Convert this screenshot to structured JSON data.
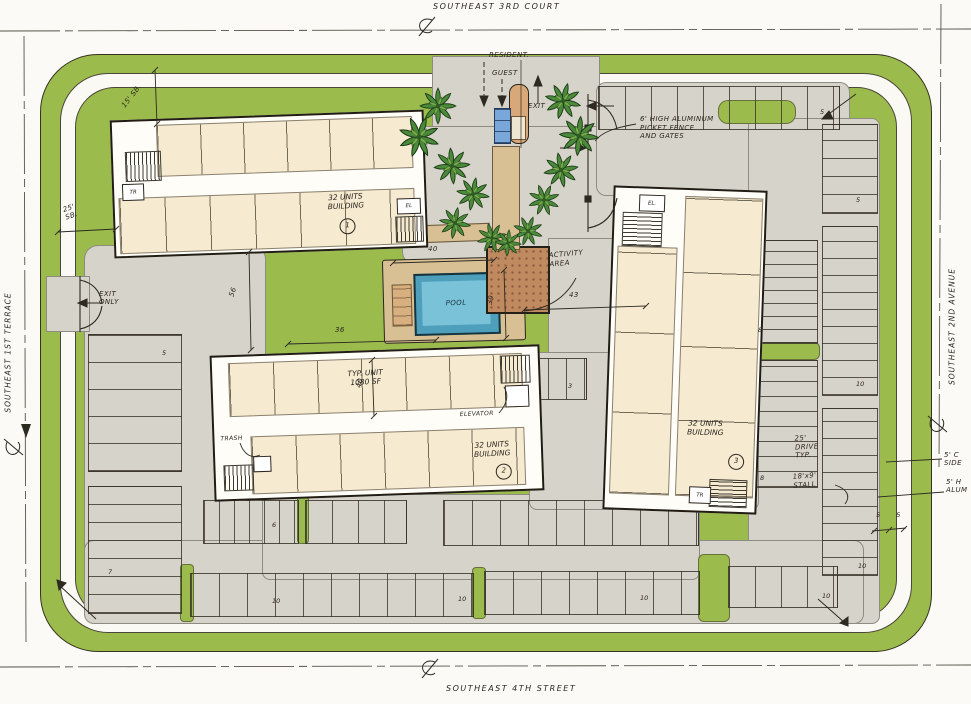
{
  "streets": {
    "top": "SOUTHEAST 3RD COURT",
    "bottom": "SOUTHEAST 4TH STREET",
    "left": "SOUTHEAST 1ST TERRACE",
    "right": "SOUTHEAST 2ND AVENUE"
  },
  "entrance": {
    "resident": "RESIDENT.",
    "guest": "GUEST",
    "exit": "EXIT"
  },
  "annotations": {
    "fence_l1": "6' HIGH ALUMINUM",
    "fence_l2": "PICKET FENCE",
    "fence_l3": "AND GATES",
    "exit_only_l1": "EXIT",
    "exit_only_l2": "ONLY",
    "drive_l1": "25'",
    "drive_l2": "DRIVE",
    "drive_l3": "TYP.",
    "stall_l1": "18'x9'",
    "stall_l2": "STALL",
    "edge1_l1": "5' C",
    "edge1_l2": "SIDE",
    "edge2_l1": "5' H",
    "edge2_l2": "ALUM"
  },
  "dimensions": {
    "front_setback_l1": "25'",
    "front_setback_l2": "SB.",
    "side_setback": "15' SB.",
    "d56": "56",
    "d36": "36",
    "d40_pool": "40",
    "d43": "43",
    "d39": "39",
    "d40_bldg2": "40",
    "d5_pair": "5 5"
  },
  "buildings": {
    "b1": {
      "label_l1": "32 UNITS",
      "label_l2": "BUILDING",
      "number": "1",
      "tr": "TR",
      "el": "EL"
    },
    "b2": {
      "label_l1": "32 UNITS",
      "label_l2": "BUILDING",
      "number": "2",
      "typ_l1": "TYP. UNIT",
      "typ_l2": "1080 SF",
      "elevator": "ELEVATOR",
      "trash": "TRASH"
    },
    "b3": {
      "label_l1": "32 UNITS",
      "label_l2": "BUILDING",
      "number": "3",
      "el": "EL.",
      "tr": "TR"
    }
  },
  "amenities": {
    "pool": "POOL",
    "activity_l1": "ACTIVITY",
    "activity_l2": "AREA"
  },
  "parking_counts": {
    "top_right": "5",
    "right_upper": "5",
    "right_mid": "10",
    "right_lower": "10",
    "east_upper": "8",
    "east_lower": "8",
    "bottom_1": "10",
    "bottom_2": "10",
    "bottom_3": "10",
    "bottom_4": "10",
    "left_upper": "5",
    "left_lower": "7",
    "mid_island": "6",
    "guest_small": "3"
  },
  "colors": {
    "landscape": "#9BBB4C",
    "pavement": "#D6D3CA",
    "building_fill": "#F6EBD0",
    "pool_water": "#79C2D8",
    "deck": "#D9C094",
    "activity": "#C08A61",
    "ink": "#2B2620"
  }
}
